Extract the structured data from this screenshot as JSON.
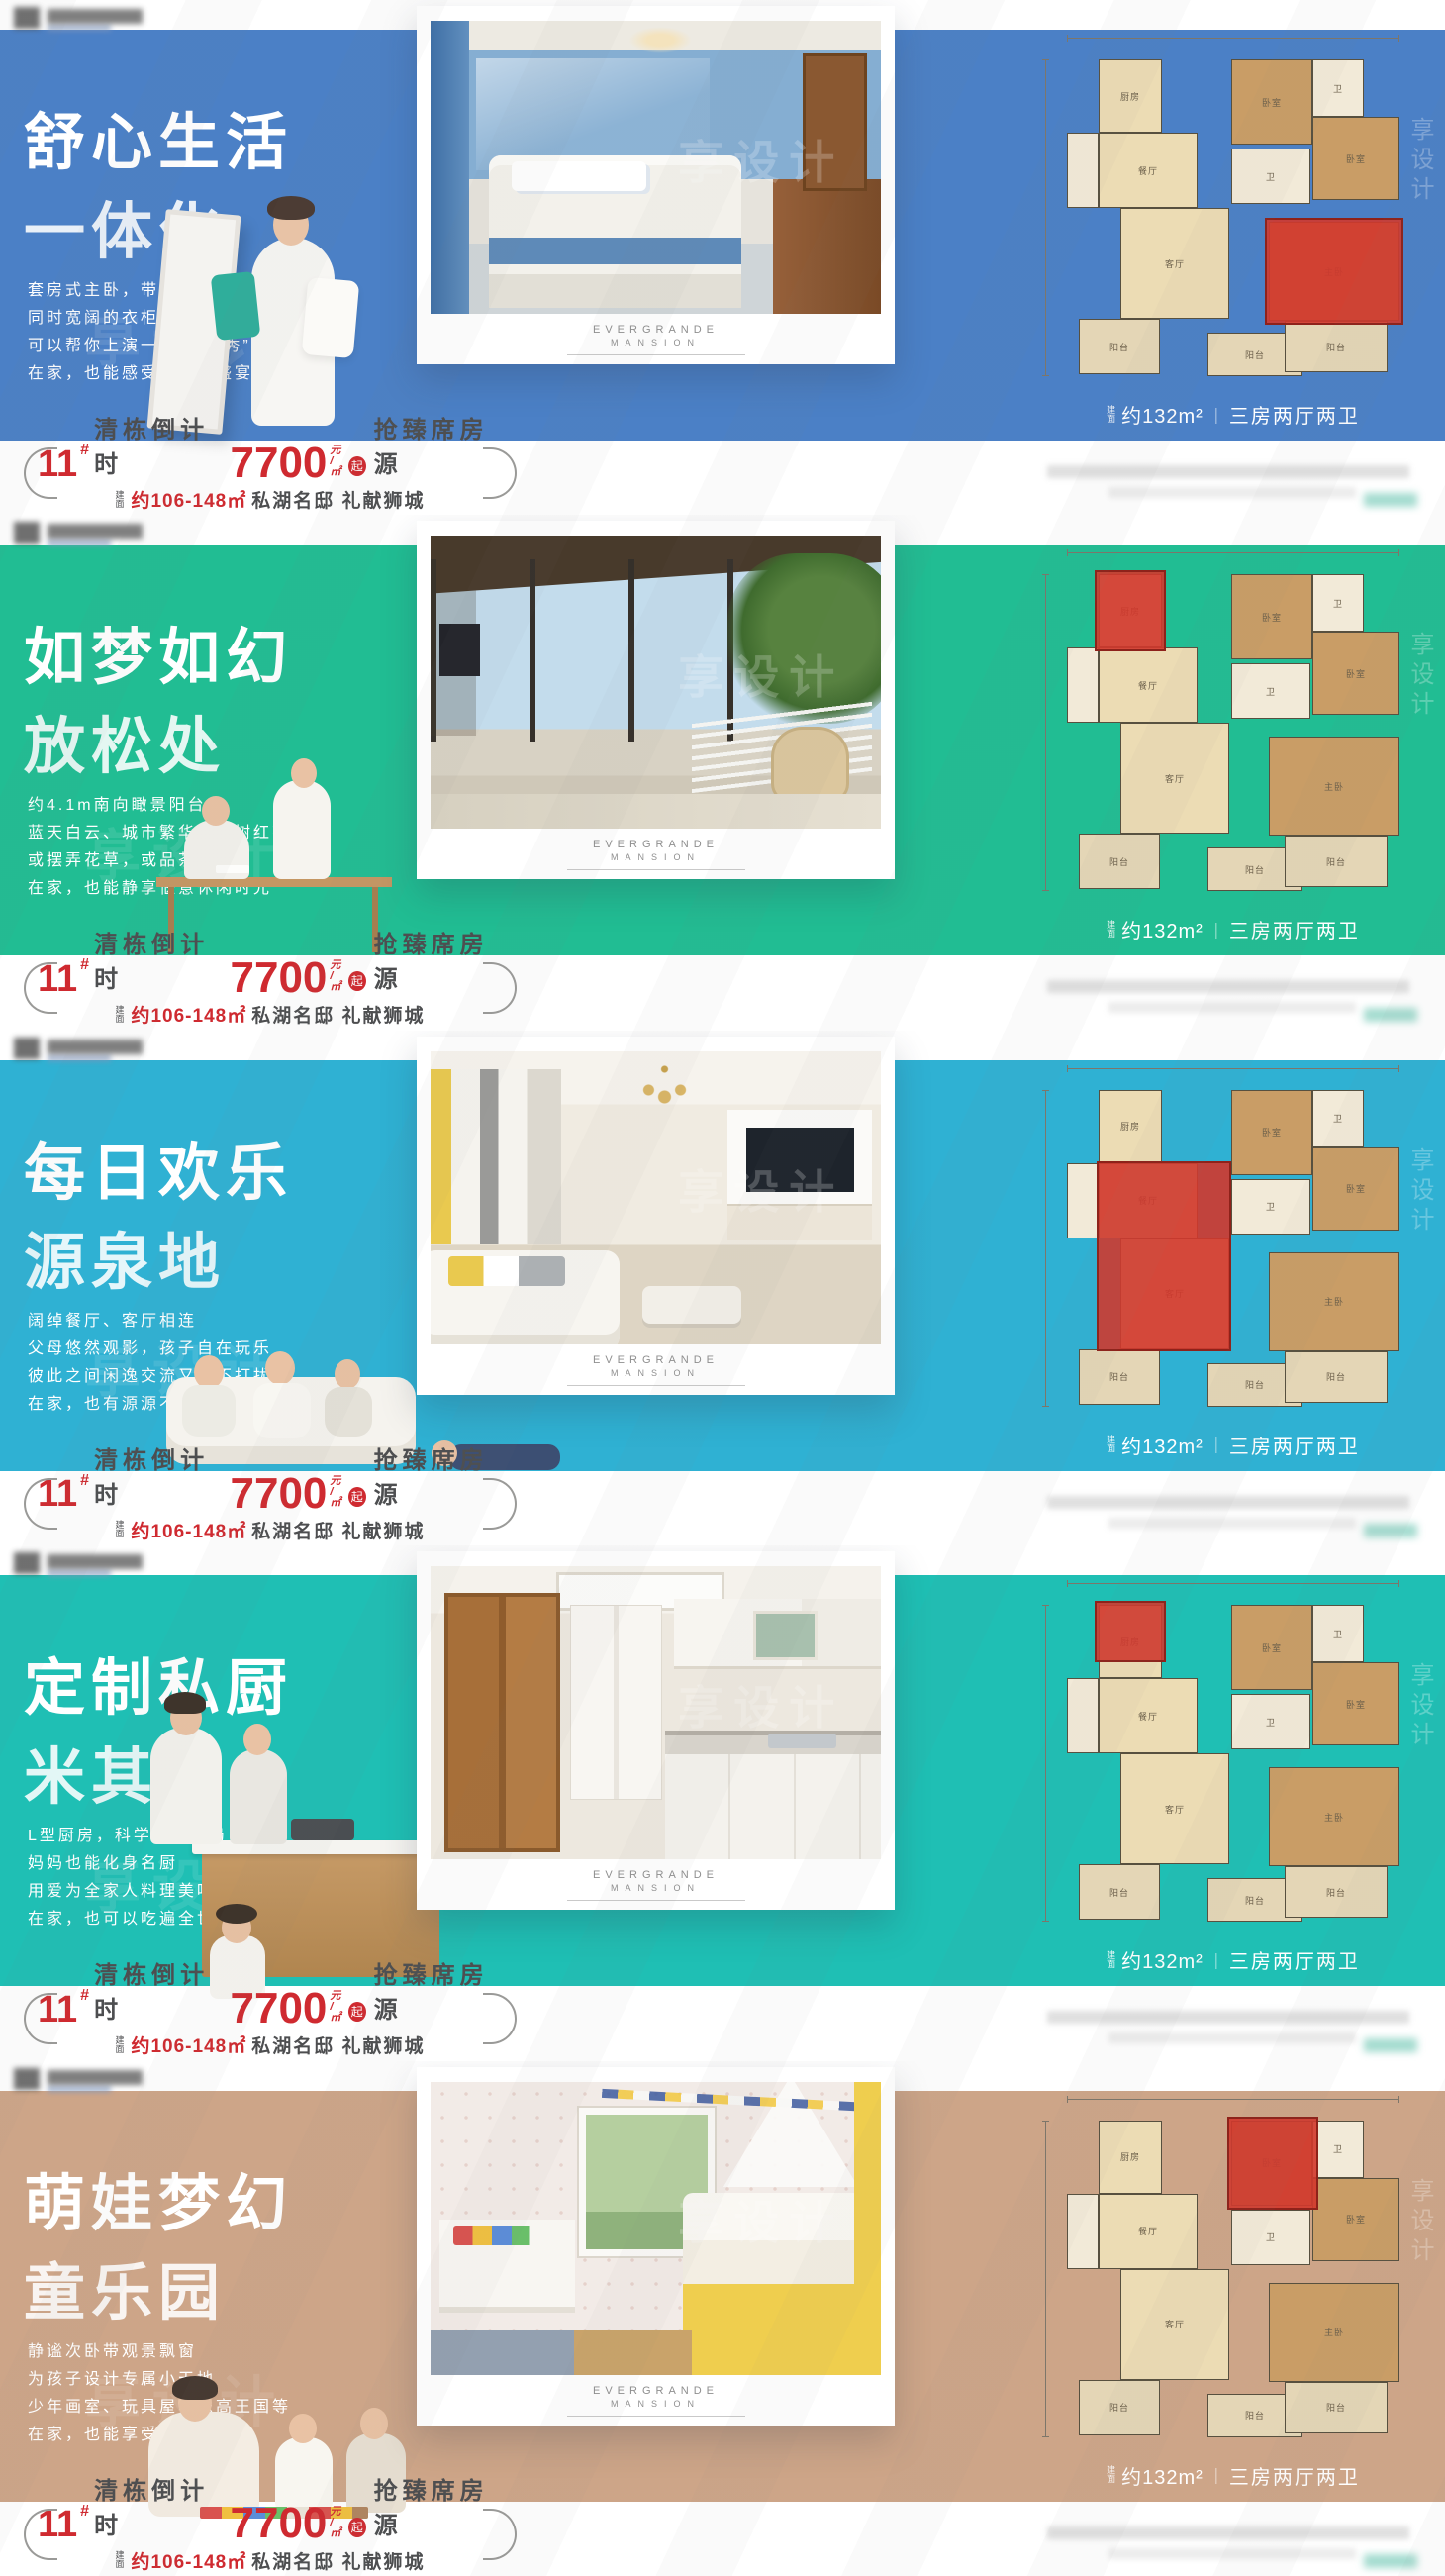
{
  "watermark": {
    "text": "享设计"
  },
  "brand": {
    "line1": "EVERGRANDE",
    "line2": "MANSION"
  },
  "price": {
    "building_no": "11",
    "hash": "#",
    "countdown": "清栋倒计时",
    "amount": "7700",
    "unit_top": "元",
    "unit_bottom": "/㎡",
    "qi": "起",
    "tail": "抢臻席房源",
    "line2_prefix": "建面",
    "line2_red": "约106-148㎡",
    "line2_rest": "私湖名邸 礼献狮城"
  },
  "floorplan": {
    "caption_prefix": "建面",
    "caption_main": "约132m²",
    "caption_sep": "｜",
    "caption_type": "三房两厅两卫",
    "labels": {
      "kitchen": "厨房",
      "dining": "餐厅",
      "living": "客厅",
      "balcony": "阳台",
      "bedroom": "卧室",
      "bedroom2": "卧室",
      "master": "主卧",
      "bath": "卫",
      "balcony2": "阳台"
    }
  },
  "banners": [
    {
      "bg": "#4b80c6",
      "scene": "sc-bedroom",
      "highlight": "master",
      "title_line1": "舒心生活",
      "title_line2": "一体化",
      "desc": [
        "套房式主卧，带独立卫浴",
        "同时宽阔的衣柜",
        "可以帮你上演一场“服装秀”",
        "在家，也能感受时装周盛宴"
      ]
    },
    {
      "bg": "#21bd93",
      "scene": "sc-balcony",
      "highlight": "kitchen-balcony",
      "title_line1": "如梦如幻",
      "title_line2": "放松处",
      "desc": [
        "约4.1m南向瞰景阳台",
        "蓝天白云、城市繁华、绿树红花",
        "或摆弄花草，或品茶阅读",
        "在家，也能静享惬意休闲时光"
      ]
    },
    {
      "bg": "#2fb1d3",
      "scene": "sc-living",
      "highlight": "living-dining",
      "title_line1": "每日欢乐",
      "title_line2": "源泉地",
      "desc": [
        "阔绰餐厅、客厅相连",
        "父母悠然观影，孩子自在玩乐",
        "彼此之间闲逸交流又互不打扰",
        "在家，也有源源不断的欢乐"
      ]
    },
    {
      "bg": "#1fbfb4",
      "scene": "sc-kitchen",
      "highlight": "kitchen",
      "title_line1": "定制私厨",
      "title_line2": "米其林",
      "desc": [
        "L型厨房，科学合理布局",
        "妈妈也能化身名厨",
        "用爱为全家人料理美味",
        "在家，也可以吃遍全世界"
      ]
    },
    {
      "bg": "#cda588",
      "scene": "sc-kids",
      "highlight": "kids-bedroom",
      "title_line1": "萌娃梦幻",
      "title_line2": "童乐园",
      "desc": [
        "静谧次卧带观景飘窗",
        "为孩子设计专属小天地",
        "少年画室、玩具屋、乐高王国等",
        "在家，也能享受童趣时光"
      ]
    }
  ]
}
